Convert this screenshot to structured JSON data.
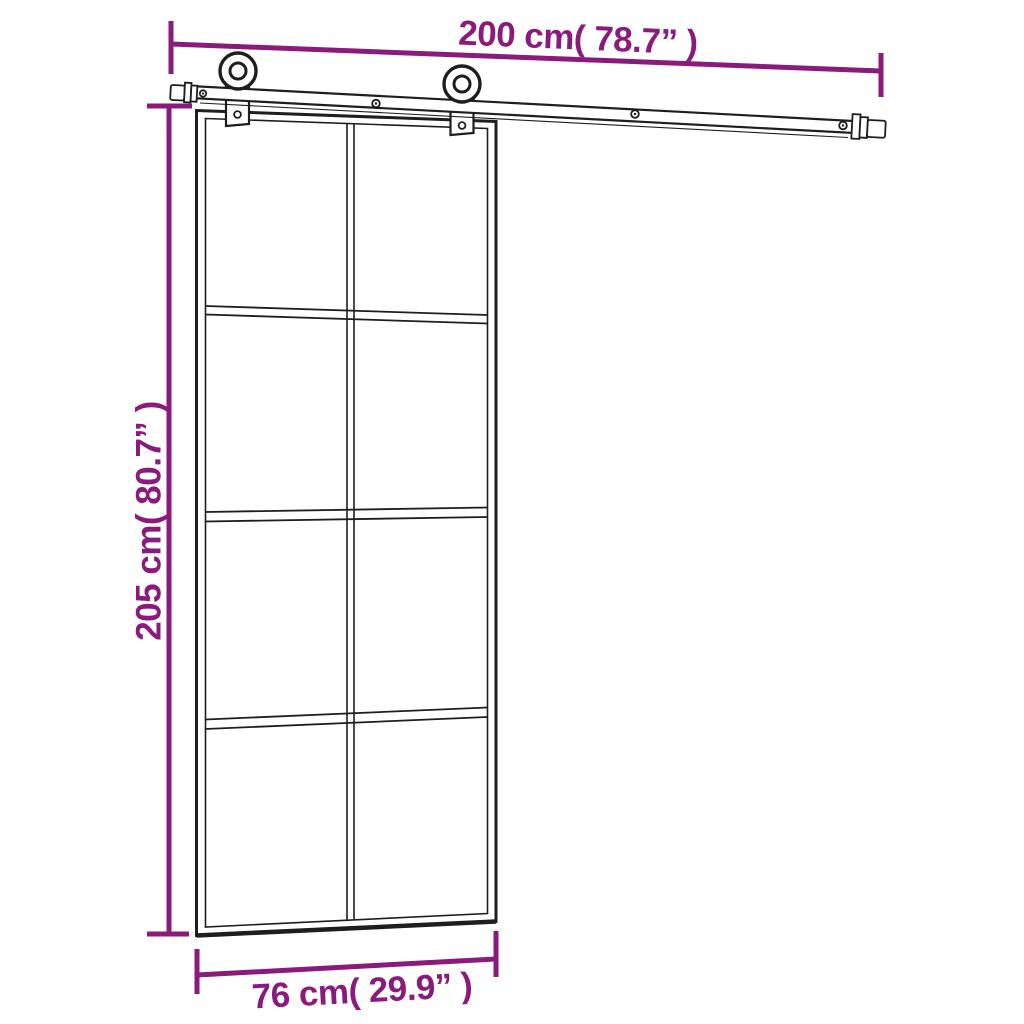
{
  "diagram": {
    "type": "product-dimension-diagram",
    "subject": "sliding-glass-door-with-rail-hardware-kit",
    "colors": {
      "accent": "#8A1A7C",
      "line": "#1E1E1E",
      "fill": "#FFFFFF"
    },
    "door": {
      "glass_columns": 2,
      "glass_rows": 4,
      "panes": 8,
      "rollers": 2,
      "rail_screws": 4
    },
    "dimensions": {
      "rail_width": {
        "label": "200 cm( 78.7” )",
        "position": "top"
      },
      "door_height": {
        "label": "205 cm( 80.7” )",
        "position": "left"
      },
      "door_width": {
        "label": "76 cm( 29.9” )",
        "position": "bottom"
      }
    }
  }
}
